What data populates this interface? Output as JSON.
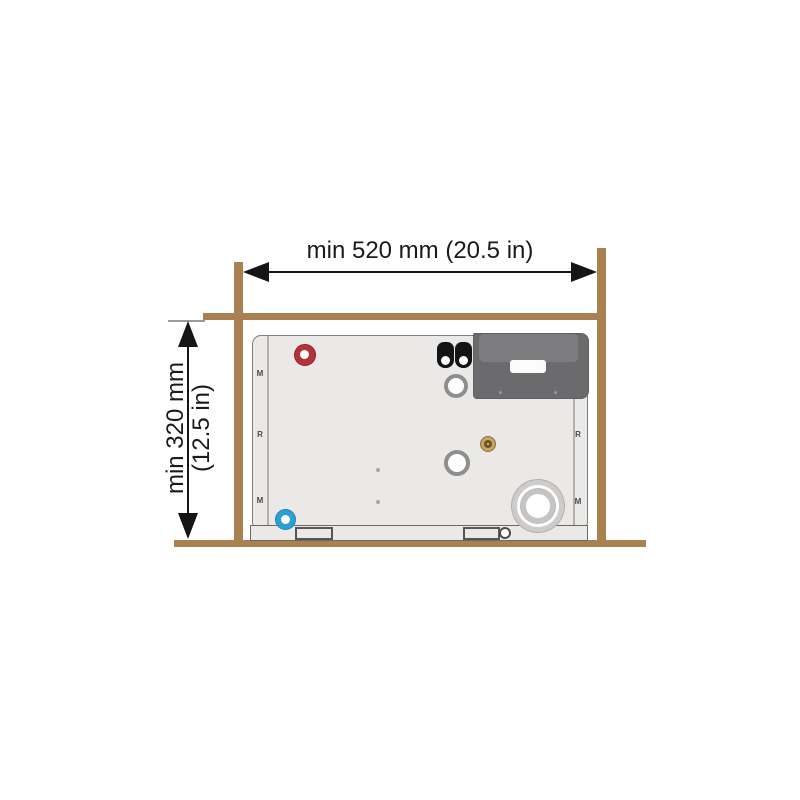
{
  "diagram": {
    "title": "appliance-installation-clearance-diagram",
    "width_dimension": {
      "label": "min 520 mm (20.5 in)"
    },
    "height_dimension": {
      "line1": "min 320 mm",
      "line2": "(12.5 in)"
    },
    "unit_markings": {
      "left": [
        "M",
        "R",
        "M"
      ],
      "right": [
        "R",
        "M"
      ]
    },
    "colors": {
      "wood_frame": "#a9804f",
      "unit_panel": "#eae9e7",
      "control_box": "#6b6b6d",
      "red_port": "#b2333a",
      "blue_port": "#2e9fd4",
      "brass_fitting": "#c7a263",
      "dimension_ink": "#151515"
    }
  }
}
